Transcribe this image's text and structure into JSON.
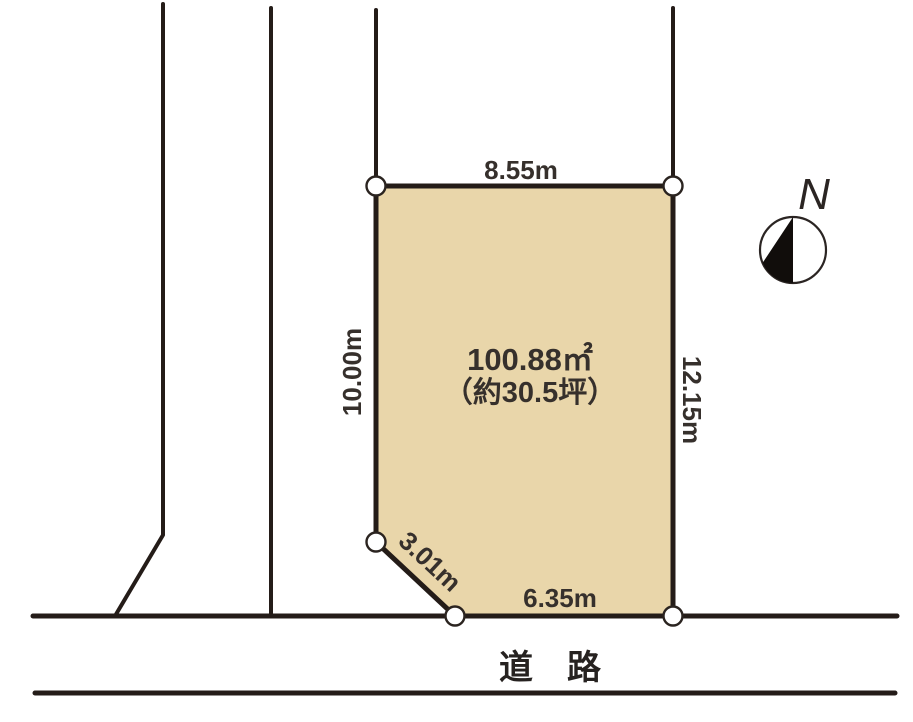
{
  "diagram": {
    "type": "land-plot-layout",
    "parcel": {
      "area_label": "100.88㎡",
      "area_tsubo_label": "（約30.5坪）"
    },
    "dimensions": {
      "top": "8.55m",
      "left": "10.00m",
      "right": "12.15m",
      "corner_cut": "3.01m",
      "bottom": "6.35m"
    },
    "road_label": "道　路",
    "compass_label": "N",
    "colors": {
      "parcel_fill": "#e9d6aa",
      "line": "#241c18",
      "text": "#36302c",
      "background": "#ffffff"
    }
  }
}
